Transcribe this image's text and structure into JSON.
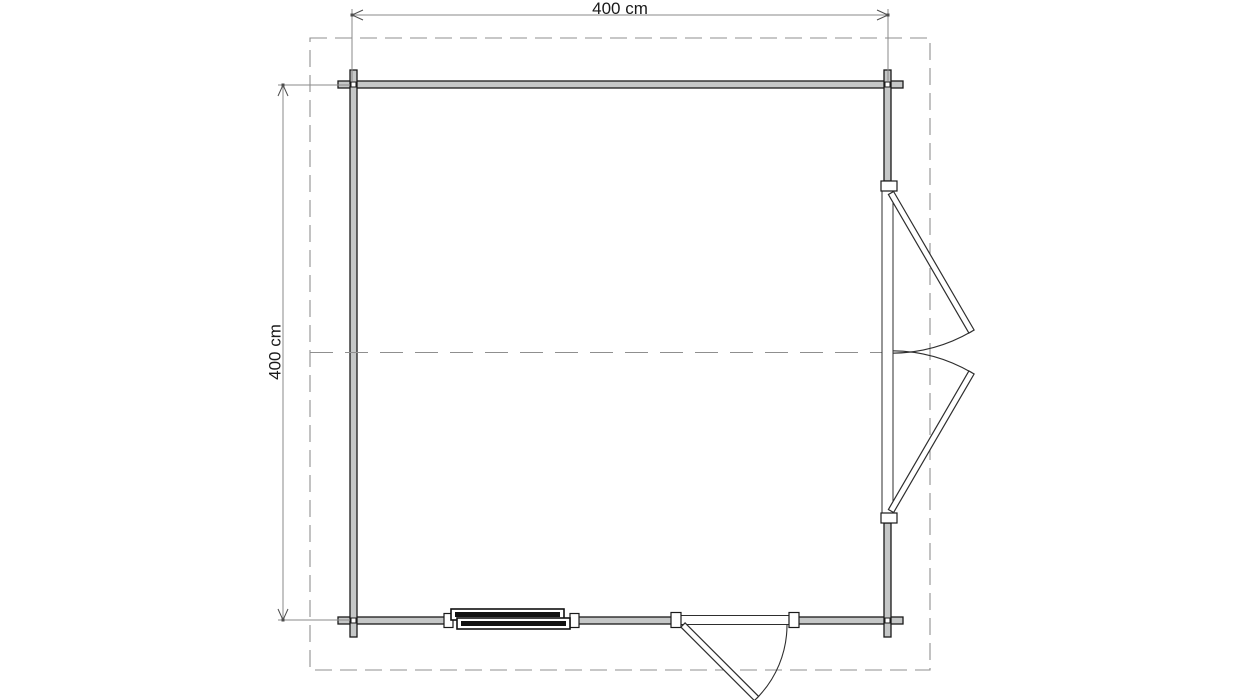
{
  "labels": {
    "top_dimension": "400 cm",
    "left_dimension": "400 cm"
  },
  "colors": {
    "background": "#ffffff",
    "wall_fill": "#c5c7c7",
    "wall_stroke": "#1a1a1a",
    "dash": "#8f8f8f",
    "dim_line": "#8a8a8a",
    "dim_arrow": "#4d4d4d",
    "door_stroke": "#2e2e2e",
    "window_dark": "#111111",
    "text": "#1a1a1a"
  },
  "plan": {
    "overhang": {
      "x": 310,
      "y": 38,
      "w": 620,
      "h": 632,
      "dash": "17 8"
    },
    "centerline": {
      "x1": 310,
      "y": 352.5,
      "x2": 892,
      "dash": "23 12"
    },
    "walls": [
      {
        "name": "wall-top",
        "x": 338,
        "y": 81,
        "w": 565,
        "h": 7
      },
      {
        "name": "wall-bottom-left",
        "x": 338,
        "y": 617,
        "w": 109,
        "h": 7
      },
      {
        "name": "wall-bottom-mid",
        "x": 576,
        "y": 617,
        "w": 105,
        "h": 7
      },
      {
        "name": "wall-bottom-right",
        "x": 789,
        "y": 617,
        "w": 114,
        "h": 7
      },
      {
        "name": "wall-left",
        "x": 350,
        "y": 70,
        "w": 7,
        "h": 567
      },
      {
        "name": "wall-right-upper",
        "x": 884,
        "y": 70,
        "w": 7,
        "h": 111
      },
      {
        "name": "wall-right-lower",
        "x": 884,
        "y": 523,
        "w": 7,
        "h": 114
      }
    ],
    "corner_joints": [
      {
        "cx": 353.5,
        "cy": 84.5
      },
      {
        "cx": 887.5,
        "cy": 84.5
      },
      {
        "cx": 353.5,
        "cy": 620.5
      },
      {
        "cx": 887.5,
        "cy": 620.5
      }
    ],
    "corner_joint_size": 5,
    "window": {
      "jambs": [
        {
          "x": 444,
          "y": 613.5,
          "w": 9,
          "h": 14
        },
        {
          "x": 570,
          "y": 613.5,
          "w": 9,
          "h": 14
        }
      ],
      "sashes": [
        {
          "x": 451,
          "y": 609,
          "w": 113,
          "h": 11
        },
        {
          "x": 457,
          "y": 618,
          "w": 113,
          "h": 11
        }
      ],
      "bars": [
        {
          "x": 455,
          "y": 612,
          "w": 105,
          "h": 5
        },
        {
          "x": 461,
          "y": 621,
          "w": 105,
          "h": 5
        }
      ]
    },
    "door_bottom": {
      "jambs": [
        {
          "x": 671,
          "y": 612.5,
          "w": 10,
          "h": 15
        },
        {
          "x": 789,
          "y": 612.5,
          "w": 10,
          "h": 15
        }
      ],
      "frame": {
        "x": 681,
        "y": 615.5,
        "w": 108,
        "h": 9
      },
      "leaves": [
        {
          "hinge": [
            683,
            625
          ],
          "tip": [
            756.5,
            698.5
          ],
          "width": 6
        }
      ],
      "arcs": [
        {
          "center": [
            683,
            625
          ],
          "from": [
            787,
            625
          ],
          "to": [
            756.5,
            698.5
          ],
          "sweep": 1
        }
      ]
    },
    "door_right": {
      "jambs": [
        {
          "x": 881,
          "y": 181,
          "w": 16,
          "h": 10
        },
        {
          "x": 881,
          "y": 513,
          "w": 16,
          "h": 10
        }
      ],
      "frame": {
        "x": 882,
        "y": 191,
        "w": 11,
        "h": 322
      },
      "leaves": [
        {
          "hinge": [
            891,
            193
          ],
          "tip": [
            971.5,
            331.5
          ],
          "width": 6
        },
        {
          "hinge": [
            891,
            511
          ],
          "tip": [
            971.5,
            372.5
          ],
          "width": 6
        }
      ],
      "arcs": [
        {
          "center": [
            891,
            193
          ],
          "from": [
            971.5,
            331.5
          ],
          "to": [
            892.5,
            353
          ],
          "sweep": 1
        },
        {
          "center": [
            891,
            511
          ],
          "from": [
            971.5,
            372.5
          ],
          "to": [
            892.5,
            351
          ],
          "sweep": 0
        }
      ]
    },
    "dim_top": {
      "line": {
        "x1": 352,
        "y": 15,
        "x2": 888
      },
      "ext": [
        {
          "x": 352,
          "y1": 9,
          "y2": 81
        },
        {
          "x": 888,
          "y1": 9,
          "y2": 81
        }
      ],
      "label_x": 620,
      "label_y": 0
    },
    "dim_left": {
      "line": {
        "x": 283,
        "y1": 85,
        "y2": 620
      },
      "ext": [
        {
          "y": 85,
          "x1": 278,
          "x2": 350
        },
        {
          "y": 620,
          "x1": 278,
          "x2": 350
        }
      ],
      "label_x": 275,
      "label_y": 352
    }
  }
}
